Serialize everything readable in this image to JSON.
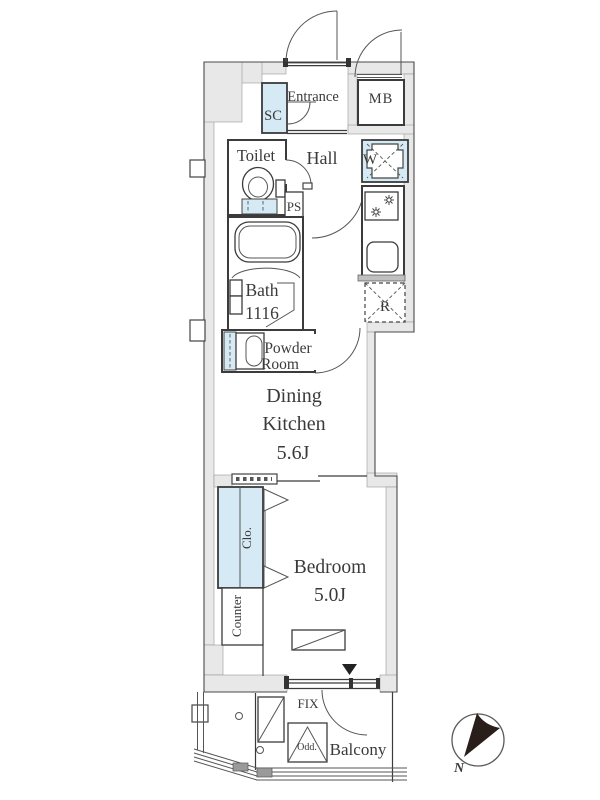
{
  "plan": {
    "labels": {
      "entrance": "Entrance",
      "meter_box": "MB",
      "shoe_closet": "SC",
      "toilet": "Toilet",
      "hall": "Hall",
      "washer": "W",
      "pipe_space": "PS",
      "bath_name": "Bath",
      "bath_size": "1116",
      "powder_line1": "Powder",
      "powder_line2": "Room",
      "fridge": "R",
      "dk_line1": "Dining",
      "dk_line2": "Kitchen",
      "dk_size": "5.6J",
      "closet": "Clo.",
      "counter": "Counter",
      "bedroom": "Bedroom",
      "bedroom_size": "5.0J",
      "fix_window": "FIX",
      "hatch": "Odd.",
      "balcony": "Balcony",
      "compass_north": "N"
    },
    "colors": {
      "fixture_blue": "#d5eaf5",
      "wall_gray": "#e8e8e8",
      "line_dark": "#3b3b3b"
    }
  }
}
